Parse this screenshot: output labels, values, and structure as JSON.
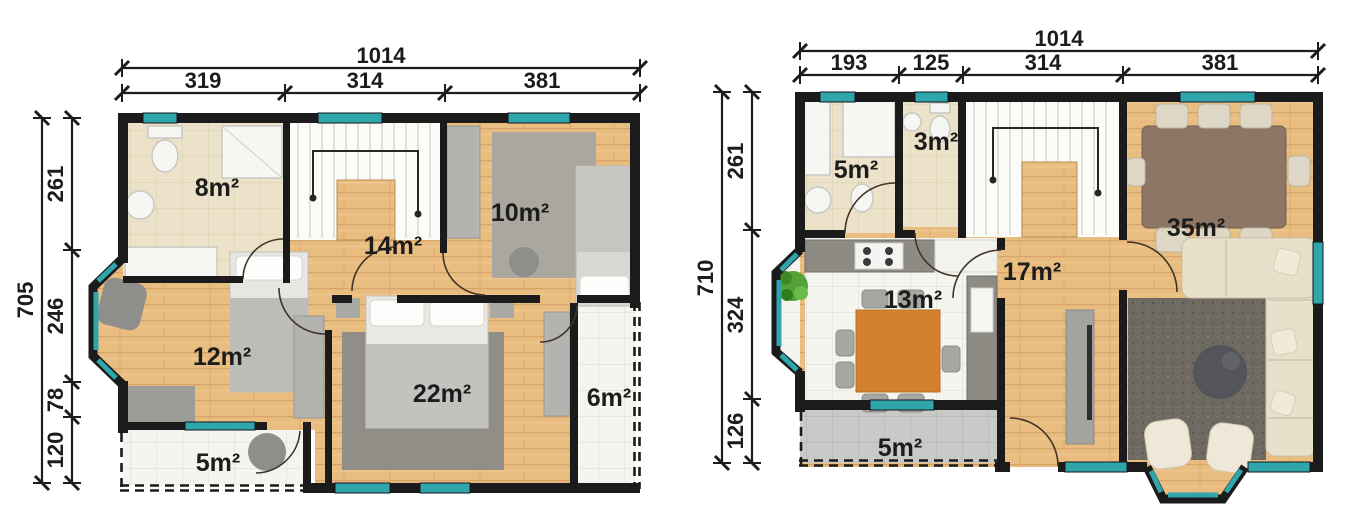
{
  "canvas": {
    "background": "#ffffff"
  },
  "colors": {
    "wall": "#1b1b1b",
    "window_glass": "#2fa6ac",
    "wood_floor": "#e9bc80",
    "beige_tile": "#ece2c9",
    "white_tile": "#f5f5f0",
    "gray_tile": "#c9c9c8",
    "dimension_text": "#1c1c1c"
  },
  "plans": [
    {
      "title": "upper-floor-plan",
      "width_total": "1014",
      "width_segments": [
        "319",
        "314",
        "381"
      ],
      "height_total": "705",
      "height_segments": [
        "261",
        "246",
        "78",
        "120"
      ],
      "rooms": {
        "bathroom": "8m²",
        "hall": "14m²",
        "bedroom_right": "10m²",
        "bedroom_left": "12m²",
        "bedroom_master": "22m²",
        "balcony_side": "6m²",
        "balcony_bottom": "5m²"
      }
    },
    {
      "title": "ground-floor-plan",
      "width_total": "1014",
      "width_segments": [
        "193",
        "125",
        "314",
        "381"
      ],
      "height_total": "710",
      "height_segments": [
        "261",
        "324",
        "126"
      ],
      "rooms": {
        "bathroom": "5m²",
        "wc": "3m²",
        "hall": "17m²",
        "kitchen": "13m²",
        "living_room": "35m²",
        "terrace": "5m²"
      }
    }
  ]
}
